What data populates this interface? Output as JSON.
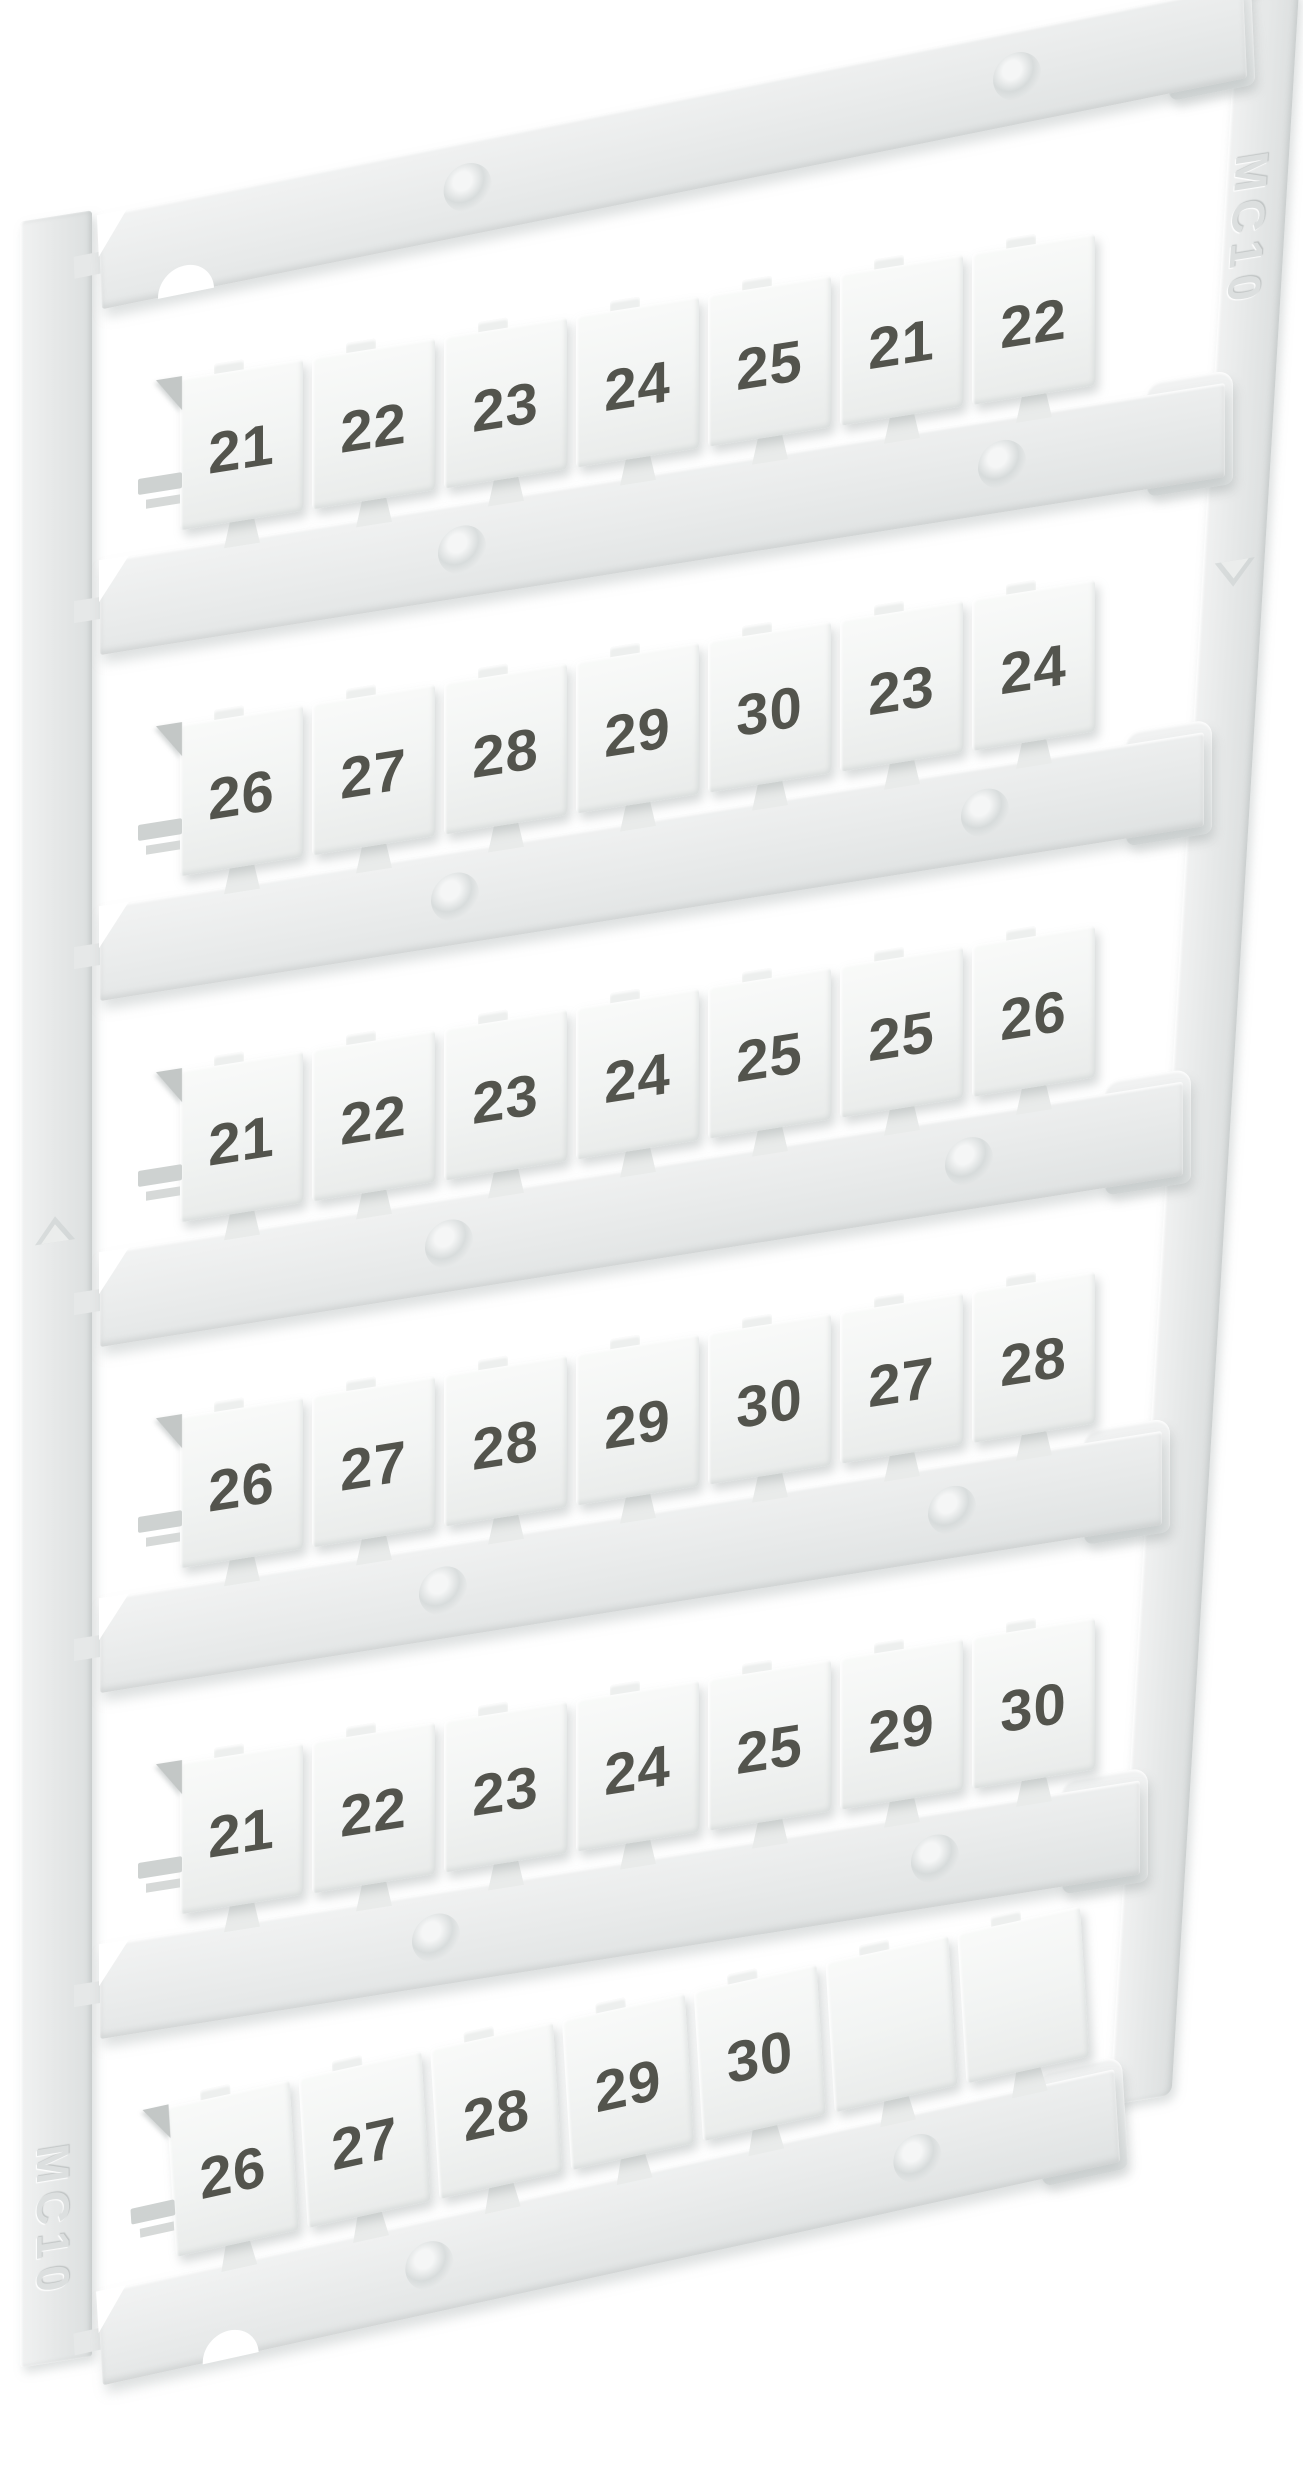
{
  "product": {
    "left_rail_label": "MC10",
    "right_rail_label": "MC10"
  },
  "sheet": {
    "rows": [
      {
        "tags": [
          "21",
          "22",
          "23",
          "24",
          "25",
          "21",
          "22"
        ]
      },
      {
        "tags": [
          "26",
          "27",
          "28",
          "29",
          "30",
          "23",
          "24"
        ]
      },
      {
        "tags": [
          "21",
          "22",
          "23",
          "24",
          "25",
          "25",
          "26"
        ]
      },
      {
        "tags": [
          "26",
          "27",
          "28",
          "29",
          "30",
          "27",
          "28"
        ]
      },
      {
        "tags": [
          "21",
          "22",
          "23",
          "24",
          "25",
          "29",
          "30"
        ]
      },
      {
        "tags": [
          "26",
          "27",
          "28",
          "29",
          "30",
          "",
          ""
        ]
      }
    ],
    "bar_count": 7,
    "tags_per_row": 7
  },
  "colors": {
    "background": "#ffffff",
    "plastic_bar": "#e9ebea",
    "plastic_tag": "#f4f5f4",
    "plastic_rail": "#e7e9e9",
    "sprue_mark": "#c3c7c6",
    "number_ink": "#53544d",
    "emboss_text": "#dcdfdf",
    "shadow": "rgba(158,165,165,0.35)"
  },
  "icons": {
    "left_rail_arrow": "emboss-arrow-up-icon",
    "right_rail_arrow": "emboss-arrow-down-icon"
  }
}
